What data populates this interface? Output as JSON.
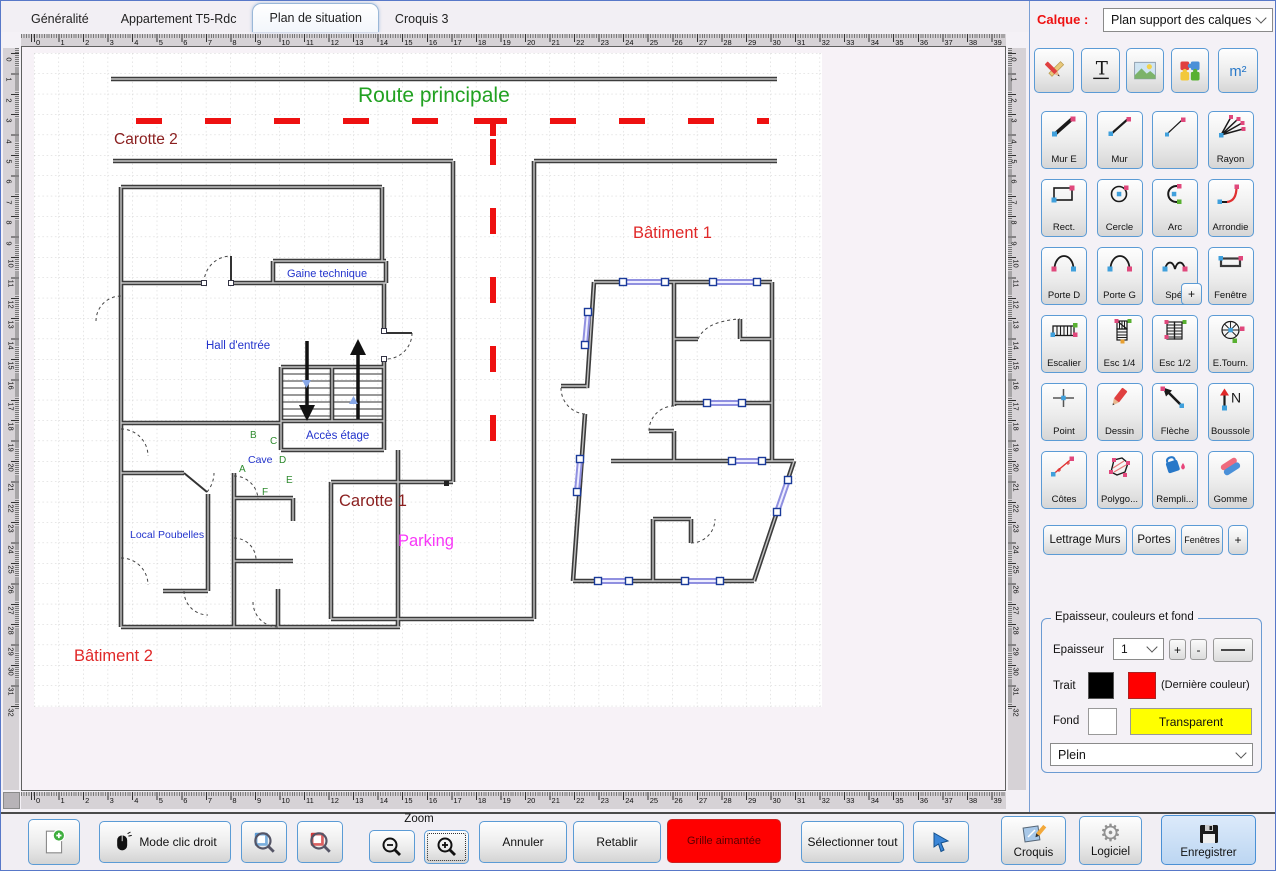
{
  "window": {
    "accent": "#5b9bd5",
    "bg": "#f4f1f6"
  },
  "tabs": [
    {
      "label": "Généralité",
      "active": false
    },
    {
      "label": "Appartement T5-Rdc",
      "active": false
    },
    {
      "label": "Plan de situation",
      "active": true
    },
    {
      "label": "Croquis 3",
      "active": false
    }
  ],
  "calque": {
    "label": "Calque :",
    "value": "Plan support des calques"
  },
  "icon_glyphs": {
    "text_tool": "T",
    "surface_tool": "m²",
    "north": "N",
    "gear": "⚙"
  },
  "tools": [
    {
      "label": "Mur E",
      "icon": "wall-thick"
    },
    {
      "label": "Mur",
      "icon": "wall-medium"
    },
    {
      "label": "",
      "icon": "wall-thin"
    },
    {
      "label": "Rayon",
      "icon": "rays"
    },
    {
      "label": "Rect.",
      "icon": "rectangle"
    },
    {
      "label": "Cercle",
      "icon": "circle"
    },
    {
      "label": "Arc",
      "icon": "arc"
    },
    {
      "label": "Arrondie",
      "icon": "rounded-corner"
    },
    {
      "label": "Porte D",
      "icon": "door-right"
    },
    {
      "label": "Porte G",
      "icon": "door-left"
    },
    {
      "label": "Spé.",
      "icon": "door-special"
    },
    {
      "label": "Fenêtre",
      "icon": "window"
    },
    {
      "label": "Escalier",
      "icon": "stairs"
    },
    {
      "label": "Esc 1/4",
      "icon": "stairs-quarter"
    },
    {
      "label": "Esc 1/2",
      "icon": "stairs-half"
    },
    {
      "label": "E.Tourn.",
      "icon": "stairs-spiral"
    },
    {
      "label": "Point",
      "icon": "point"
    },
    {
      "label": "Dessin",
      "icon": "pencil"
    },
    {
      "label": "Flèche",
      "icon": "arrow"
    },
    {
      "label": "Boussole",
      "icon": "compass"
    },
    {
      "label": "Côtes",
      "icon": "dimension"
    },
    {
      "label": "Polygo...",
      "icon": "polygon"
    },
    {
      "label": "Rempli...",
      "icon": "fill-bucket"
    },
    {
      "label": "Gomme",
      "icon": "eraser"
    }
  ],
  "spe_plus_label": "+",
  "shortcut_buttons": {
    "lettrage_murs": "Lettrage Murs",
    "portes": "Portes",
    "fenetres": "Fenêtres",
    "plus": "+"
  },
  "style_panel": {
    "title": "Epaisseur, couleurs et fond",
    "epaisseur_label": "Epaisseur",
    "epaisseur_value": "1",
    "plus": "+",
    "minus": "-",
    "trait_label": "Trait",
    "trait_colors": {
      "current": "#000000",
      "last": "#ff0000"
    },
    "derniere_couleur_note": "(Dernière couleur)",
    "fond_label": "Fond",
    "fond_color": "#ffffff",
    "transparent_label": "Transparent",
    "transparent_bg": "#ffff00",
    "fill_style_value": "Plein"
  },
  "rulers": {
    "horizontal_max": 39,
    "vertical_max": 32
  },
  "bottom_bar": {
    "mode_clic_droit": "Mode clic droit",
    "zoom_label": "Zoom",
    "annuler": "Annuler",
    "retablir": "Retablir",
    "grille_aimantee": "Grille aimantée",
    "grille_bg": "#ff0000",
    "selectionner_tout": "Sélectionner tout",
    "croquis": "Croquis",
    "logiciel": "Logiciel",
    "enregistrer": "Enregistrer"
  },
  "plan": {
    "labels": [
      {
        "text": "Route principale",
        "x": 357,
        "y": 101,
        "size": 21,
        "color": "#21a121"
      },
      {
        "text": "Carotte 2",
        "x": 113,
        "y": 143,
        "size": 15.5,
        "color": "#8b2020"
      },
      {
        "text": "Bâtiment 1",
        "x": 632,
        "y": 237,
        "size": 16.5,
        "color": "#e02828"
      },
      {
        "text": "Bâtiment 2",
        "x": 73,
        "y": 660,
        "size": 16.5,
        "color": "#e02828"
      },
      {
        "text": "Carotte 1",
        "x": 338,
        "y": 505,
        "size": 16.5,
        "color": "#8b2020"
      },
      {
        "text": "Parking",
        "x": 397,
        "y": 545,
        "size": 16.5,
        "color": "#f838f8"
      },
      {
        "text": "Gaine technique",
        "x": 286,
        "y": 276,
        "size": 11,
        "color": "#2233cc"
      },
      {
        "text": "Hall d'entrée",
        "x": 205,
        "y": 348,
        "size": 11.5,
        "color": "#2233cc"
      },
      {
        "text": "Accès étage",
        "x": 305,
        "y": 438,
        "size": 11.5,
        "color": "#2233cc"
      },
      {
        "text": "Cave",
        "x": 247,
        "y": 462,
        "size": 10.5,
        "color": "#2233cc"
      },
      {
        "text": "Local Poubelles",
        "x": 129,
        "y": 537,
        "size": 10.5,
        "color": "#2233cc"
      },
      {
        "text": "A",
        "x": 238,
        "y": 471,
        "size": 10,
        "color": "#2e8b2e"
      },
      {
        "text": "B",
        "x": 249,
        "y": 437,
        "size": 10,
        "color": "#2e8b2e"
      },
      {
        "text": "C",
        "x": 269,
        "y": 443,
        "size": 10,
        "color": "#2e8b2e"
      },
      {
        "text": "D",
        "x": 278,
        "y": 462,
        "size": 10,
        "color": "#2e8b2e"
      },
      {
        "text": "E",
        "x": 285,
        "y": 482,
        "size": 10,
        "color": "#2e8b2e"
      },
      {
        "text": "F",
        "x": 261,
        "y": 494,
        "size": 10,
        "color": "#2e8b2e"
      }
    ]
  }
}
